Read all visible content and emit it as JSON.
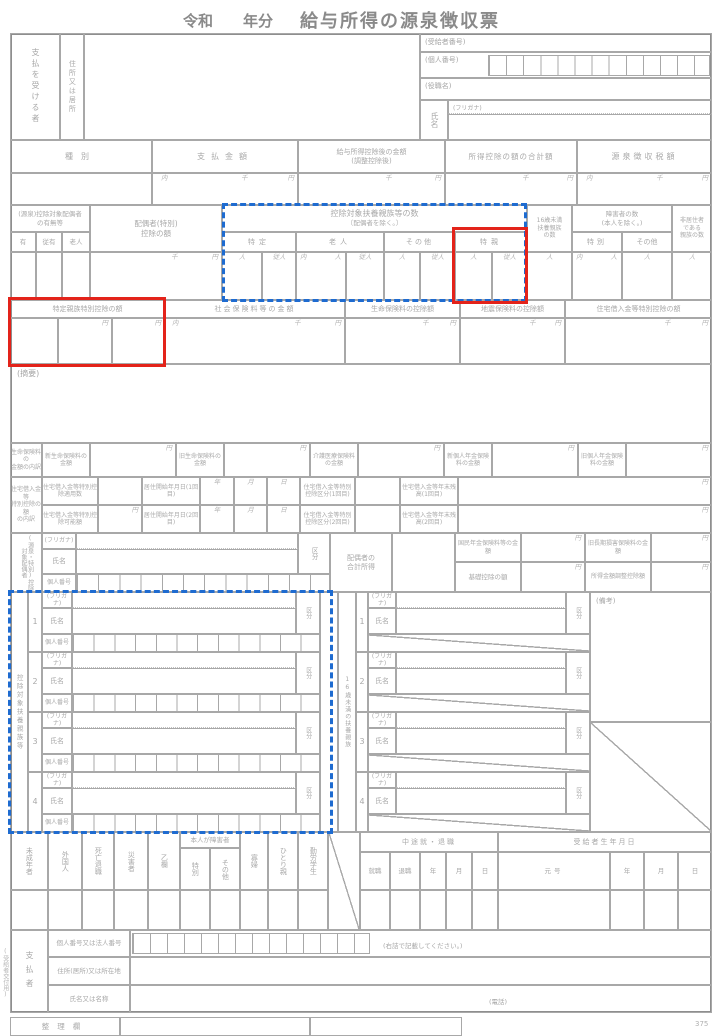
{
  "title": {
    "era": "令和",
    "year_suffix": "年分",
    "main": "給与所得の源泉徴収票"
  },
  "units": {
    "uchi": "内",
    "sen": "千",
    "yen": "円",
    "nin": "人",
    "junin": "従人",
    "yu": "有",
    "juyu": "従有"
  },
  "payee": {
    "side": "支払を受ける者",
    "address": "住所又は居所",
    "recipient_no": "(受給者番号)",
    "personal_no": "(個人番号)",
    "role": "(役職名)",
    "furigana": "(フリガナ)",
    "name": "氏名"
  },
  "amounts": {
    "type": "種別",
    "payment": "支払金額",
    "after_deduction_1": "給与所得控除後の金額",
    "after_deduction_2": "(調整控除後)",
    "total_deductions": "所得控除の額の合計額",
    "withholding": "源泉徴収税額"
  },
  "counts": {
    "spouse_header": "(源泉)控除対象配偶者",
    "spouse_header2": "の有無等",
    "rojin": "老人",
    "spouse_deduction_1": "配偶者(特別)",
    "spouse_deduction_2": "控除の額",
    "fuyo_header": "控除対象扶養親族等の数",
    "fuyo_header2": "〔配偶者を除く。〕",
    "tokutei": "特定",
    "sonota": "その他",
    "tokushin": "特親",
    "u16_1": "16歳未満",
    "u16_2": "扶養親族",
    "u16_3": "の数",
    "shogai_1": "障害者の数",
    "shogai_2": "(本人を除く。)",
    "tokubetsu": "特別",
    "hikyoju_1": "非居住者",
    "hikyoju_2": "である",
    "hikyoju_3": "親族の数"
  },
  "deduction_row": {
    "tokutei_shinzoku": "特定親族特別控除の額",
    "shakai": "社会保険料等の金額",
    "seimei": "生命保険料の控除額",
    "jishin": "地震保険料の控除額",
    "jutaku": "住宅借入金等特別控除の額"
  },
  "tekiyo": "(摘要)",
  "life_insurance": {
    "side1": "生命保険料の",
    "side2": "金額の内訳",
    "items": [
      "新生命保険料の金額",
      "旧生命保険料の金額",
      "介護医療保険料の金額",
      "新個人年金保険料の金額",
      "旧個人年金保険料の金額"
    ]
  },
  "housing": {
    "side1": "住宅借入金等",
    "side2": "特別控除の額",
    "side3": "の内訳",
    "rows": [
      {
        "a": "住宅借入金等特別控除適用数",
        "b": "居住開始年月日(1回目)",
        "c": "住宅借入金等特別控除区分(1回目)",
        "d": "住宅借入金等年末残高(1回目)"
      },
      {
        "a": "住宅借入金等特別控除可能額",
        "b": "居住開始年月日(2回目)",
        "c": "住宅借入金等特別控除区分(2回目)",
        "d": "住宅借入金等年末残高(2回目)"
      }
    ],
    "date_units": [
      "年",
      "月",
      "日"
    ]
  },
  "spouse": {
    "side": "(源泉・特別)控除対象配偶者",
    "furigana": "(フリガナ)",
    "name": "氏名",
    "personal_no": "個人番号",
    "kubun": "区分",
    "gokei_1": "配偶者の",
    "gokei_2": "合計所得",
    "kokumin": "国民年金保険料等の金額",
    "kyuchoki": "旧長期損害保険料の金額",
    "kiso": "基礎控除の額",
    "chosei": "所得金額調整控除額"
  },
  "dependents": {
    "side_left": "控除対象扶養親族等",
    "side_right": "16歳未満の扶養親族",
    "furigana": "(フリガナ)",
    "name": "氏名",
    "personal_no": "個人番号",
    "kubun": "区分",
    "biko": "(備考)",
    "rows": [
      "1",
      "2",
      "3",
      "4"
    ]
  },
  "flags": {
    "cols": [
      "未成年者",
      "外国人",
      "死亡退職",
      "災害者",
      "乙欄"
    ],
    "honnin": "本人が障害者",
    "honnin_cols": [
      "特別",
      "その他"
    ],
    "cols2": [
      "寡婦",
      "ひとり親",
      "勤労学生"
    ],
    "chuto": "中途就・退職",
    "chuto_cols": [
      "就職",
      "退職",
      "年",
      "月",
      "日"
    ],
    "birth": "受給者生年月日",
    "birth_cols": [
      "元号",
      "年",
      "月",
      "日"
    ]
  },
  "payer": {
    "side": "支払者",
    "row1": "個人番号又は法人番号",
    "note": "(右詰で記載してください。)",
    "row2": "住所(居所)又は所在地",
    "row3": "氏名又は名称",
    "tel": "(電話)"
  },
  "footer": {
    "seiri": "整理欄",
    "code": "375",
    "copy_note": "(受給者交付用)"
  }
}
